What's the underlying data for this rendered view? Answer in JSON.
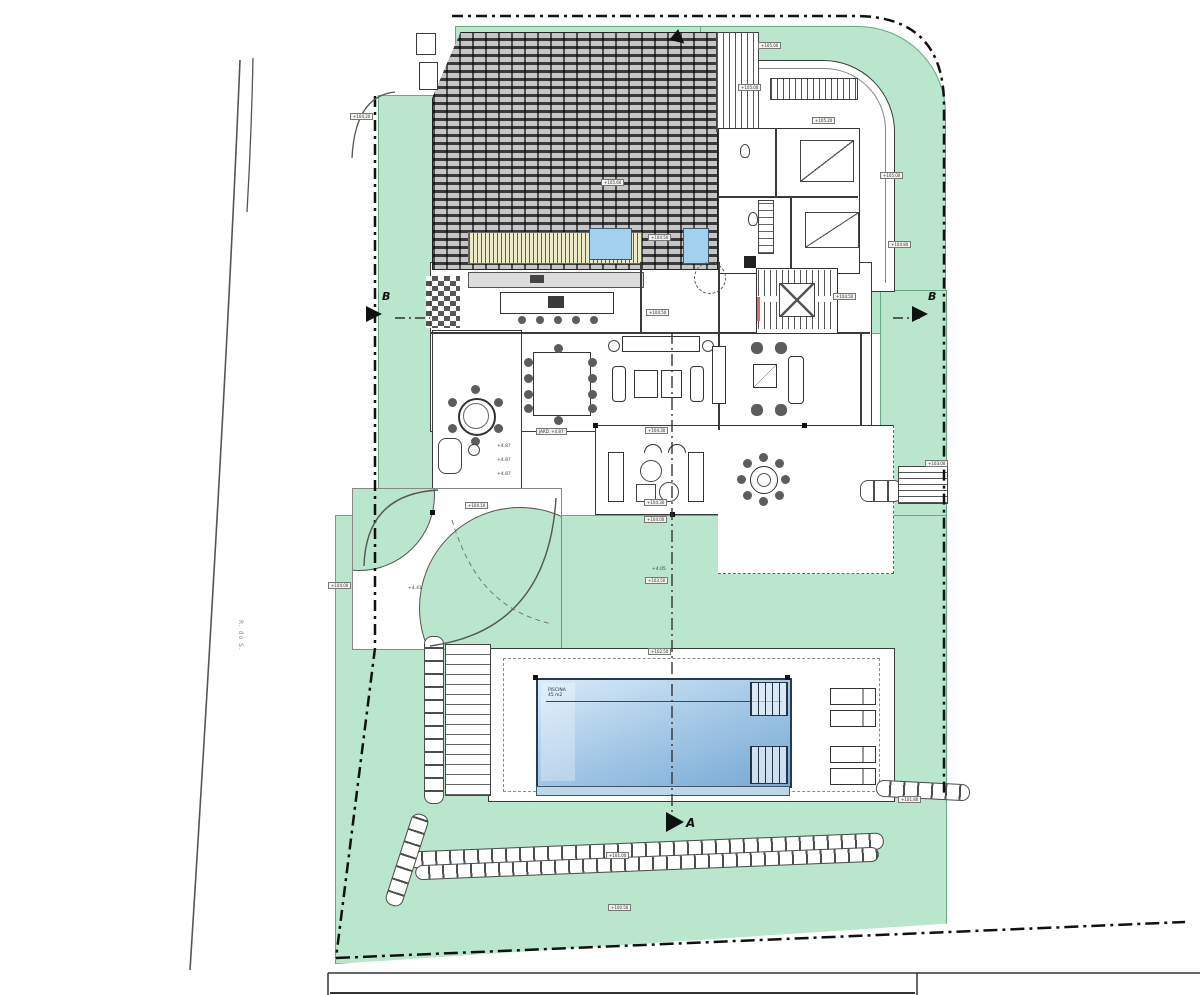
{
  "drawing": {
    "type": "architectural-site-plan",
    "section_markers": {
      "a": "A",
      "b_left": "B",
      "b_right": "B"
    },
    "road_label": "R. do S.",
    "pool": {
      "line1": "PISCINA",
      "line2": "45 m2"
    }
  },
  "tags": [
    {
      "x": 350,
      "y": 113,
      "label": "+104.20"
    },
    {
      "x": 758,
      "y": 42,
      "label": "+105.00"
    },
    {
      "x": 738,
      "y": 84,
      "label": "+105.00"
    },
    {
      "x": 812,
      "y": 117,
      "label": "+105.20"
    },
    {
      "x": 880,
      "y": 172,
      "label": "+105.00"
    },
    {
      "x": 888,
      "y": 241,
      "label": "+104.80"
    },
    {
      "x": 601,
      "y": 179,
      "label": "+105.60"
    },
    {
      "x": 648,
      "y": 234,
      "label": "+104.50"
    },
    {
      "x": 833,
      "y": 293,
      "label": "+104.50"
    },
    {
      "x": 646,
      "y": 309,
      "label": "+104.50"
    },
    {
      "x": 645,
      "y": 427,
      "label": "+104.30"
    },
    {
      "x": 644,
      "y": 499,
      "label": "+104.30"
    },
    {
      "x": 644,
      "y": 516,
      "label": "+104.00"
    },
    {
      "x": 645,
      "y": 577,
      "label": "+103.50"
    },
    {
      "x": 465,
      "y": 502,
      "label": "+104.10"
    },
    {
      "x": 328,
      "y": 582,
      "label": "+104.00"
    },
    {
      "x": 648,
      "y": 648,
      "label": "+102.50"
    },
    {
      "x": 606,
      "y": 852,
      "label": "+101.00"
    },
    {
      "x": 608,
      "y": 904,
      "label": "+100.50"
    },
    {
      "x": 925,
      "y": 460,
      "label": "+103.00"
    },
    {
      "x": 898,
      "y": 796,
      "label": "+101.80"
    },
    {
      "x": 536,
      "y": 428,
      "label": "JARD. +4.87"
    }
  ],
  "texts": [
    {
      "x": 408,
      "y": 586,
      "label": "+4.41"
    },
    {
      "x": 652,
      "y": 567,
      "label": "+4.05"
    },
    {
      "x": 497,
      "y": 444,
      "label": "+4.87"
    },
    {
      "x": 497,
      "y": 458,
      "label": "+4.87"
    },
    {
      "x": 497,
      "y": 472,
      "label": "+4.87"
    }
  ],
  "colors": {
    "green": "#b9e6cc",
    "pool_light": "#d9ebf8",
    "pool_dark": "#76a9d4",
    "water": "#a3d0ec",
    "roof_tile": "#c6c6c6",
    "roof_gap": "#3a3a3a"
  }
}
